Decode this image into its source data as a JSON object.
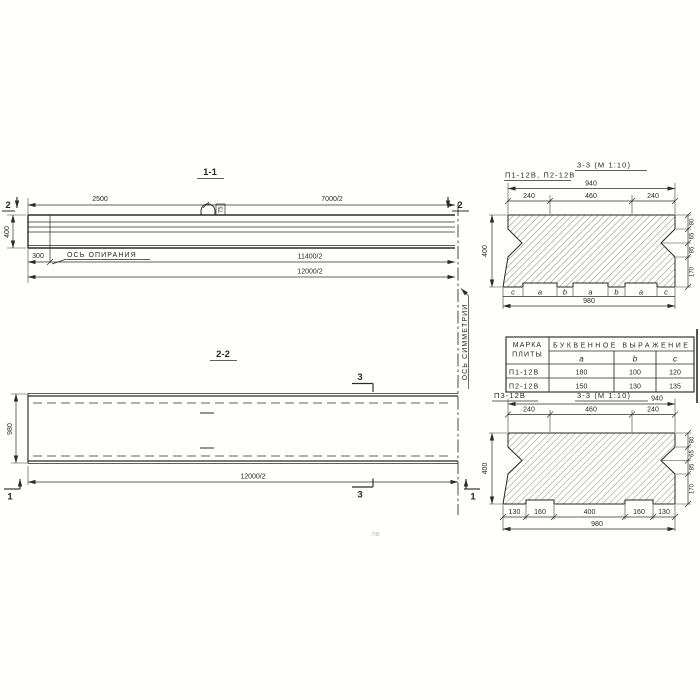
{
  "colors": {
    "ink": "#2b2b2b",
    "paper": "#ffffff"
  },
  "view_1_1": {
    "title": "1-1",
    "dim_2500": "2500",
    "dim_7000_2": "7000/2",
    "dim_11400_2": "11400/2",
    "dim_12000_2": "12000/2",
    "dim_300": "300",
    "dim_400": "400",
    "support_axis_label": "ОСЬ ОПИРАНИЯ",
    "hook_label": "75",
    "cut_label_left": "2",
    "cut_label_right": "2"
  },
  "view_2_2": {
    "title": "2-2",
    "dim_980": "980",
    "dim_12000_2": "12000/2",
    "cut_label_3_top": "3",
    "cut_label_3_bottom": "3",
    "cut_label_1_left": "1",
    "cut_label_1_right": "1"
  },
  "symmetry_axis_label": "ОСЬ СИММЕТРИИ",
  "section_pi1": {
    "label": "П1-12В, П2-12В",
    "title": "3-3 (М 1:10)",
    "dim_total_top": "940",
    "dims_top": [
      "240",
      "460",
      "240"
    ],
    "dim_left": "400",
    "dims_right": [
      "80",
      "65",
      "85",
      "170"
    ],
    "letters": [
      "c",
      "a",
      "b",
      "a",
      "b",
      "a",
      "c"
    ],
    "dim_total_bottom": "980"
  },
  "table": {
    "col_mark_line1": "МАРКА",
    "col_mark_line2": "ПЛИТЫ",
    "header_expression": "БУКВЕННОЕ  ВЫРАЖЕНИЕ",
    "col_a": "a",
    "col_b": "b",
    "col_c": "c",
    "rows": [
      {
        "mark": "П1-12В",
        "a": "180",
        "b": "100",
        "c": "120"
      },
      {
        "mark": "П2-12В",
        "a": "150",
        "b": "130",
        "c": "135"
      }
    ]
  },
  "section_pi3": {
    "label": "П3-12В",
    "title": "3-3 (М 1:10)",
    "dim_total_top": "940",
    "dims_top": [
      "240",
      "460",
      "240"
    ],
    "dim_left": "400",
    "dims_right": [
      "80",
      "65",
      "85",
      "170"
    ],
    "dims_bottom": [
      "130",
      "160",
      "400",
      "160",
      "130"
    ],
    "dim_total_bottom": "980"
  },
  "faint_note": "пв"
}
